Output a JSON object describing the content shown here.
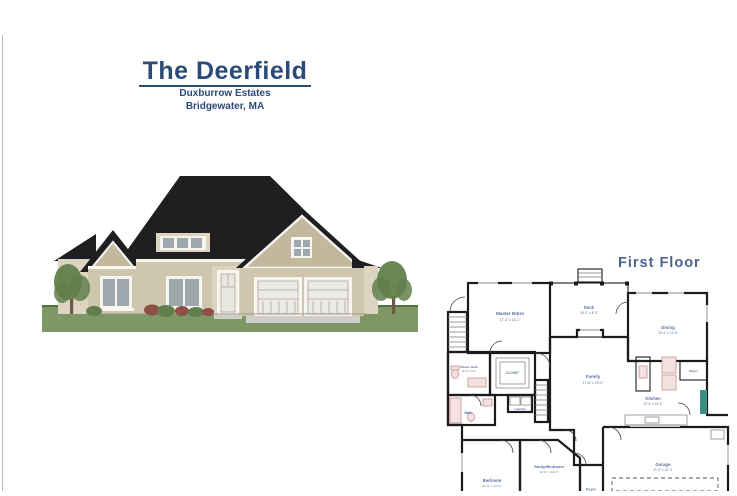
{
  "document": {
    "title": "The Deerfield",
    "subtitle": "Duxburrow Estates",
    "location": "Bridgewater, MA"
  },
  "floor_plan": {
    "title": "First Floor",
    "rooms": {
      "master_bdrm": {
        "name": "Master Bdrm",
        "dims": "17'-4\" x 14'-2\""
      },
      "deck": {
        "name": "Deck",
        "dims": "16'-2\" x 8'-0\""
      },
      "dining": {
        "name": "Dining",
        "dims": "10'-4\" x 13'-6\""
      },
      "master_bath": {
        "name": "Master Bath",
        "dims": "10'-0\" x 6'-0\""
      },
      "closet": {
        "name": "CLOSET"
      },
      "laundry": {
        "name": "Laundry"
      },
      "bath": {
        "name": "Bath"
      },
      "family": {
        "name": "Family",
        "dims": "17'-6\" x 19'-0\""
      },
      "kitchen": {
        "name": "Kitchen",
        "dims": "12'-0\" x 15'-0\""
      },
      "pantry": {
        "name": "Pantry"
      },
      "bedroom": {
        "name": "Bedroom",
        "dims": "11'-0\" x 12'-0\""
      },
      "study_bedroom": {
        "name": "Study/Bedroom",
        "dims": "11'-0\" x 12'-0\""
      },
      "garage": {
        "name": "Garage",
        "dims": "21'-0\" x 22'-0\""
      },
      "foyer": {
        "name": "Foyer"
      }
    }
  },
  "colors": {
    "title_text": "#2b4a78",
    "plan_title": "#4d6390",
    "plan_text": "#5c6f9c",
    "wall": "#1b1b1b",
    "roof": "#1f1e20",
    "siding": "#cfc6ae",
    "siding_light": "#dcd4c0",
    "gable_shingle": "#c3b89e",
    "trim": "#f6f5f0",
    "window_pane": "#9fa8ac",
    "lawn": "#7d9765",
    "lawn_dark": "#55703f",
    "tree": "#617f4c",
    "bush_red": "#8e4f44",
    "fixture": "#c9908e",
    "fixture_fill": "#f3e2e1",
    "accent_teal": "#3f8f84",
    "concrete": "#cfcec8"
  }
}
